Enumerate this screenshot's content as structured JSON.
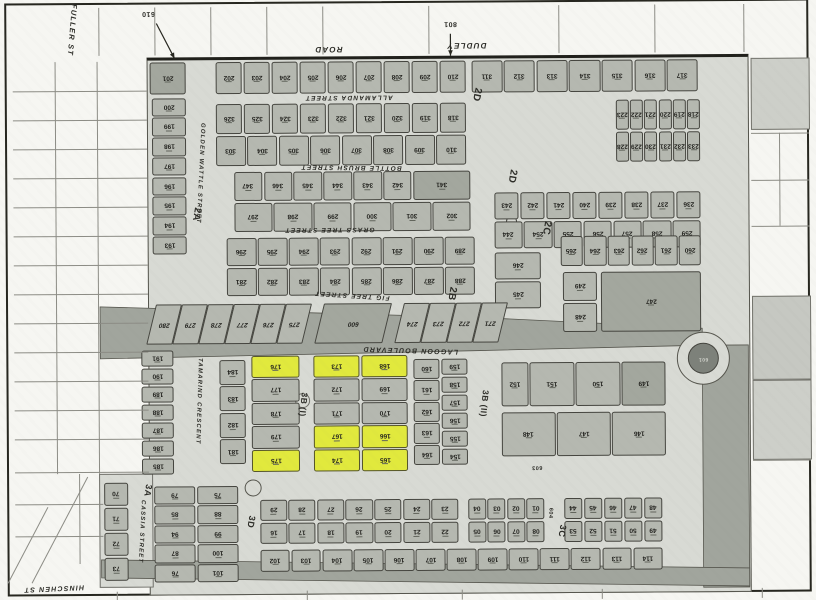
{
  "title": "Scanned subdivision survey plan",
  "colors": {
    "paper": "#f6f6f2",
    "road": "#d8dad4",
    "lot": "#b5b8b0",
    "lot_dark": "#a3a79e",
    "highlight": "#e1e93d",
    "band": "#a1a59d",
    "roundabout": "#7d817a",
    "line": "#26261f"
  },
  "street_labels": [
    {
      "id": "street-label-fuller",
      "t": "FULLER ST",
      "x": 74,
      "y": 28,
      "r": 95,
      "s": 7.5
    },
    {
      "id": "street-label-dudley",
      "t": "DUDLEY",
      "x": 468,
      "y": 46,
      "r": 180,
      "s": 8
    },
    {
      "id": "street-label-road",
      "t": "ROAD",
      "x": 330,
      "y": 49,
      "r": 180,
      "s": 8
    },
    {
      "id": "street-label-allamanda",
      "t": "ALLAMANDA STREET",
      "x": 350,
      "y": 97,
      "r": 180,
      "s": 6.5
    },
    {
      "id": "street-label-bottle-brush",
      "t": "BOTTLE BRUSH STREET",
      "x": 352,
      "y": 167,
      "r": 181,
      "s": 6.5
    },
    {
      "id": "street-label-grass-tree",
      "t": "GRASS TREE STREET",
      "x": 330,
      "y": 229,
      "r": 180,
      "s": 6.5
    },
    {
      "id": "street-label-fig-tree",
      "t": "FIG TREE STREET",
      "x": 352,
      "y": 295,
      "r": 184,
      "s": 6.5
    },
    {
      "id": "street-label-lagoon-blvd",
      "t": "LAGOON BOULEVARD",
      "x": 410,
      "y": 350,
      "r": 182,
      "s": 7
    },
    {
      "id": "street-label-golden-wattle",
      "t": "GOLDEN WATTLE STREET",
      "x": 201,
      "y": 172,
      "r": 93,
      "s": 6
    },
    {
      "id": "street-label-tamarind",
      "t": "TAMARIND CRESCENT",
      "x": 198,
      "y": 400,
      "r": 92,
      "s": 6
    },
    {
      "id": "street-label-cassia",
      "t": "CASSIA STREET",
      "x": 140,
      "y": 530,
      "r": 93,
      "s": 6
    },
    {
      "id": "street-label-hinschen",
      "t": "HINSCHEN ST",
      "x": 52,
      "y": 586,
      "r": 178,
      "s": 7
    }
  ],
  "section_labels": [
    {
      "id": "section-2a",
      "t": "2A",
      "x": 197,
      "y": 213,
      "r": 100,
      "s": 10
    },
    {
      "id": "section-2d-north",
      "t": "2D",
      "x": 478,
      "y": 95,
      "r": 102,
      "s": 10
    },
    {
      "id": "section-2d-mid",
      "t": "2D",
      "x": 513,
      "y": 177,
      "r": 100,
      "s": 10
    },
    {
      "id": "section-2c",
      "t": "2C",
      "x": 547,
      "y": 229,
      "r": 100,
      "s": 10
    },
    {
      "id": "section-2b",
      "t": "2B",
      "x": 452,
      "y": 294,
      "r": 100,
      "s": 10
    },
    {
      "id": "section-3b-i",
      "t": "3B (I)",
      "x": 303,
      "y": 404,
      "r": 96,
      "s": 8.5
    },
    {
      "id": "section-3b-ii",
      "t": "3B (II)",
      "x": 484,
      "y": 404,
      "r": 96,
      "s": 8.5
    },
    {
      "id": "section-3a",
      "t": "3A",
      "x": 147,
      "y": 489,
      "r": 100,
      "s": 9
    },
    {
      "id": "section-3d",
      "t": "3D",
      "x": 250,
      "y": 521,
      "r": 100,
      "s": 9
    },
    {
      "id": "section-3c",
      "t": "3C",
      "x": 561,
      "y": 532,
      "r": 100,
      "s": 9
    }
  ],
  "misc_labels": [
    {
      "id": "road-lot-601",
      "t": "601",
      "x": 703,
      "y": 361,
      "r": 180,
      "s": 5,
      "c": "#d2d4cd"
    },
    {
      "id": "road-lot-603",
      "t": "603",
      "x": 536,
      "y": 468,
      "r": 180,
      "s": 5.5
    },
    {
      "id": "road-lot-604",
      "t": "604",
      "x": 549,
      "y": 514,
      "r": 94,
      "s": 5.5
    }
  ],
  "annotations": [
    {
      "id": "annotation-610",
      "t": "610",
      "x": 150,
      "y": 12,
      "r": 180,
      "s": 7,
      "arrow": [
        158,
        22,
        176,
        57
      ]
    },
    {
      "id": "annotation-801",
      "t": "801",
      "x": 452,
      "y": 24,
      "r": 180,
      "s": 7,
      "arrow": [
        452,
        34,
        452,
        56
      ]
    }
  ],
  "blocks": [
    {
      "id": "lot-201-block",
      "x": 150,
      "y": 60,
      "w": 38,
      "h": 34,
      "rows": [
        [
          {
            "n": "201",
            "dk": true
          }
        ]
      ]
    },
    {
      "id": "row-dudley-west",
      "x": 216,
      "y": 60,
      "w": 252,
      "h": 34,
      "rows": [
        [
          "202",
          "203",
          "204",
          "205",
          "206",
          "207",
          "208",
          "209",
          "210"
        ]
      ]
    },
    {
      "id": "row-dudley-east",
      "x": 472,
      "y": 60,
      "w": 228,
      "h": 34,
      "rows": [
        [
          "311",
          "312",
          "313",
          "314",
          "315",
          "316",
          "317"
        ]
      ]
    },
    {
      "id": "block-allamanda",
      "x": 216,
      "y": 102,
      "w": 252,
      "h": 64,
      "rows": [
        [
          "326",
          "325",
          "324",
          "323",
          "322",
          "321",
          "320",
          "319",
          "318"
        ],
        [
          "303",
          "304",
          "305",
          "306",
          "307",
          "308",
          "309",
          "310"
        ]
      ]
    },
    {
      "id": "block-2d-east",
      "x": 616,
      "y": 100,
      "w": 86,
      "h": 64,
      "rows": [
        [
          "223",
          "222",
          "221",
          "220",
          "219",
          "218"
        ],
        [
          "228",
          "229",
          "230",
          "231",
          "232",
          "233"
        ]
      ]
    },
    {
      "id": "block-bottle-brush",
      "x": 234,
      "y": 170,
      "w": 238,
      "h": 62,
      "rows": [
        [
          "347",
          "346",
          "345",
          "344",
          "343",
          "342",
          {
            "n": "341",
            "wt": 2.1,
            "dk": true
          }
        ],
        [
          "297",
          "298",
          "299",
          "300",
          "301",
          "302"
        ]
      ]
    },
    {
      "id": "block-2c-east",
      "x": 494,
      "y": 192,
      "w": 208,
      "h": 58,
      "rows": [
        [
          "243",
          "242",
          "241",
          "240",
          "239",
          "238",
          "237",
          "236"
        ],
        [
          "244",
          "254",
          "255",
          "256",
          "257",
          "258",
          "259"
        ]
      ]
    },
    {
      "id": "block-grass-tree",
      "x": 226,
      "y": 236,
      "w": 250,
      "h": 60,
      "rows": [
        [
          "296",
          "295",
          "294",
          "293",
          "292",
          "291",
          "290",
          "289"
        ],
        [
          "281",
          "282",
          "283",
          "284",
          "285",
          "286",
          "287",
          "288"
        ]
      ]
    },
    {
      "id": "block-260s",
      "x": 560,
      "y": 236,
      "w": 142,
      "h": 32,
      "rows": [
        [
          "265",
          "264",
          "263",
          "262",
          "261",
          "260"
        ]
      ]
    },
    {
      "id": "block-245",
      "x": 494,
      "y": 252,
      "w": 48,
      "h": 58,
      "rows": [
        [
          "246"
        ],
        [
          "245"
        ]
      ]
    },
    {
      "id": "block-248",
      "x": 562,
      "y": 272,
      "w": 36,
      "h": 62,
      "rows": [
        [
          "249"
        ],
        [
          "248"
        ]
      ]
    },
    {
      "id": "block-247",
      "x": 600,
      "y": 272,
      "w": 102,
      "h": 62,
      "rows": [
        [
          {
            "n": "247",
            "dk": true
          }
        ]
      ]
    },
    {
      "id": "col-2a",
      "x": 152,
      "y": 96,
      "w": 36,
      "h": 158,
      "cols": [
        [
          "200",
          "199",
          "198",
          "197",
          "196",
          "195",
          "194",
          "193"
        ]
      ]
    },
    {
      "id": "col-tamarind-west",
      "x": 140,
      "y": 348,
      "w": 34,
      "h": 126,
      "cols": [
        [
          "191",
          "190",
          "189",
          "188",
          "187",
          "186",
          "185"
        ]
      ]
    },
    {
      "id": "col-tamarind-east",
      "x": 218,
      "y": 358,
      "w": 28,
      "h": 106,
      "cols": [
        [
          "184",
          "183",
          "182",
          "181"
        ]
      ]
    },
    {
      "id": "col-3b-yellow",
      "x": 250,
      "y": 354,
      "w": 50,
      "h": 118,
      "cols": [
        [
          {
            "n": "176",
            "hl": true
          },
          "177",
          "178",
          "179",
          {
            "n": "175",
            "hl": true
          }
        ]
      ]
    },
    {
      "id": "block-3b-mid",
      "x": 312,
      "y": 354,
      "w": 96,
      "h": 118,
      "cols": [
        [
          {
            "n": "173",
            "hl": true
          },
          "172",
          "171",
          {
            "n": "167",
            "hl": true
          },
          {
            "n": "174",
            "hl": true
          }
        ],
        [
          {
            "n": "168",
            "hl": true
          },
          "169",
          "170",
          {
            "n": "166",
            "hl": true
          },
          {
            "n": "165",
            "hl": true
          }
        ]
      ]
    },
    {
      "id": "block-160s",
      "x": 412,
      "y": 358,
      "w": 56,
      "h": 108,
      "cols": [
        [
          "160",
          "161",
          "162",
          "163",
          "164"
        ],
        [
          "159",
          "158",
          "157",
          "156",
          "155",
          "154"
        ]
      ]
    },
    {
      "id": "block-150s-north",
      "x": 500,
      "y": 362,
      "w": 166,
      "h": 46,
      "rows": [
        [
          {
            "n": "152",
            "wt": 0.6
          },
          "151",
          "150",
          {
            "n": "149",
            "dk": true
          }
        ]
      ]
    },
    {
      "id": "block-150s-south",
      "x": 500,
      "y": 412,
      "w": 166,
      "h": 46,
      "rows": [
        [
          "148",
          "147",
          "146"
        ]
      ]
    },
    {
      "id": "col-cassia-west",
      "x": 102,
      "y": 480,
      "w": 26,
      "h": 100,
      "cols": [
        [
          "70",
          "71",
          "72",
          "73"
        ]
      ]
    },
    {
      "id": "block-cassia-east",
      "x": 152,
      "y": 484,
      "w": 86,
      "h": 98,
      "cols": [
        [
          "79",
          "85",
          "94",
          "87",
          "76"
        ],
        [
          "75",
          "88",
          "99",
          "100",
          "101"
        ]
      ]
    },
    {
      "id": "block-3d",
      "x": 258,
      "y": 498,
      "w": 200,
      "h": 46,
      "rows": [
        [
          "29",
          "28",
          "27",
          "26",
          "25",
          "24",
          "23"
        ],
        [
          "16",
          "17",
          "18",
          "19",
          "20",
          "21",
          "22"
        ]
      ]
    },
    {
      "id": "block-3d-east",
      "x": 466,
      "y": 498,
      "w": 78,
      "h": 46,
      "rows": [
        [
          "04",
          "03",
          "02",
          "01"
        ],
        [
          "05",
          "06",
          "07",
          "08"
        ]
      ]
    },
    {
      "id": "block-3c",
      "x": 562,
      "y": 498,
      "w": 100,
      "h": 46,
      "rows": [
        [
          "44",
          "45",
          "46",
          "47",
          "48"
        ],
        [
          "53",
          "52",
          "51",
          "50",
          "49"
        ]
      ]
    },
    {
      "id": "row-bottom",
      "x": 258,
      "y": 548,
      "w": 404,
      "h": 24,
      "rows": [
        [
          "102",
          "103",
          "104",
          "105",
          "106",
          "107",
          "108",
          "109",
          "110",
          "111",
          "112",
          "113",
          "114"
        ]
      ]
    }
  ],
  "skew_lots": {
    "y": 302,
    "h": 38,
    "w": 24,
    "cells": [
      {
        "n": "280",
        "x": 150
      },
      {
        "n": "279",
        "x": 176
      },
      {
        "n": "278",
        "x": 202
      },
      {
        "n": "277",
        "x": 228
      },
      {
        "n": "276",
        "x": 254
      },
      {
        "n": "275",
        "x": 280
      },
      {
        "n": "600",
        "x": 318,
        "w": 66,
        "dk": true
      },
      {
        "n": "274",
        "x": 398
      },
      {
        "n": "273",
        "x": 424
      },
      {
        "n": "272",
        "x": 450
      },
      {
        "n": "271",
        "x": 476
      }
    ]
  },
  "bands": [
    {
      "id": "reserve-band",
      "pts": "100,305 480,318 702,330 702,347 480,351 100,357"
    },
    {
      "id": "east-road-band",
      "pts": "702,347 748,347 748,589 702,589"
    },
    {
      "id": "south-road-band",
      "pts": "100,558 748,570 748,588 100,576"
    }
  ],
  "circles": [
    {
      "id": "roundabout-outer",
      "cx": 703,
      "cy": 360,
      "r": 26,
      "fill": "#d8dad4",
      "stroke": "#55554d"
    },
    {
      "id": "roundabout-island",
      "cx": 703,
      "cy": 360,
      "r": 15,
      "fill": "#7d817a",
      "stroke": "#45453f"
    },
    {
      "id": "mini-roundabout-south",
      "cx": 252,
      "cy": 487,
      "r": 8,
      "fill": "#d8dad4",
      "stroke": "#55554d"
    },
    {
      "id": "street-bulb-3b",
      "cx": 302,
      "cy": 400,
      "r": 7,
      "fill": "#d8dad4",
      "stroke": "#70706a"
    },
    {
      "id": "road-marker-2d",
      "cx": 512,
      "cy": 222,
      "r": 5,
      "fill": "none",
      "stroke": "#45453f"
    }
  ],
  "grid_lines": [
    {
      "x": 100,
      "y": 6,
      "w": 1,
      "h": 48
    },
    {
      "x": 156,
      "y": 6,
      "w": 1,
      "h": 48
    },
    {
      "x": 212,
      "y": 6,
      "w": 1,
      "h": 48
    },
    {
      "x": 268,
      "y": 6,
      "w": 1,
      "h": 48
    },
    {
      "x": 324,
      "y": 6,
      "w": 1,
      "h": 48
    },
    {
      "x": 430,
      "y": 6,
      "w": 1,
      "h": 48
    },
    {
      "x": 560,
      "y": 6,
      "w": 1,
      "h": 48
    },
    {
      "x": 656,
      "y": 6,
      "w": 1,
      "h": 48
    },
    {
      "x": 745,
      "y": 6,
      "w": 1,
      "h": 48
    },
    {
      "x": 56,
      "y": 60,
      "w": 1,
      "h": 412
    },
    {
      "x": 98,
      "y": 60,
      "w": 1,
      "h": 412
    },
    {
      "x": 78,
      "y": 472,
      "w": 1,
      "h": 90
    },
    {
      "x": 14,
      "y": 470,
      "w": 134,
      "h": 1
    },
    {
      "x": 14,
      "y": 502,
      "w": 88,
      "h": 1
    },
    {
      "x": 14,
      "y": 534,
      "w": 88,
      "h": 1
    },
    {
      "x": 752,
      "y": 135,
      "w": 58,
      "h": 1
    },
    {
      "x": 752,
      "y": 182,
      "w": 58,
      "h": 1
    },
    {
      "x": 752,
      "y": 228,
      "w": 58,
      "h": 1
    },
    {
      "x": 780,
      "y": 135,
      "w": 1,
      "h": 93
    },
    {
      "x": 752,
      "y": 462,
      "w": 58,
      "h": 1
    },
    {
      "x": 115,
      "y": 590,
      "w": 1,
      "h": 10
    },
    {
      "x": 305,
      "y": 590,
      "w": 1,
      "h": 10
    },
    {
      "x": 460,
      "y": 590,
      "w": 1,
      "h": 10
    },
    {
      "x": 600,
      "y": 590,
      "w": 1,
      "h": 10
    },
    {
      "x": 760,
      "y": 590,
      "w": 1,
      "h": 10
    }
  ],
  "grid_repeat": {
    "x": 14,
    "w": 134,
    "y0": 89,
    "step": 29,
    "count": 13
  },
  "outside_patches": [
    {
      "id": "rural-lot-ne",
      "x": 752,
      "y": 60,
      "w": 57,
      "h": 70,
      "fill": "#cdcfc9"
    },
    {
      "id": "rural-lot-e1",
      "x": 752,
      "y": 298,
      "w": 57,
      "h": 82,
      "fill": "#c6c8c2"
    },
    {
      "id": "rural-lot-e2",
      "x": 752,
      "y": 382,
      "w": 57,
      "h": 78,
      "fill": "#cdcfc9"
    }
  ]
}
